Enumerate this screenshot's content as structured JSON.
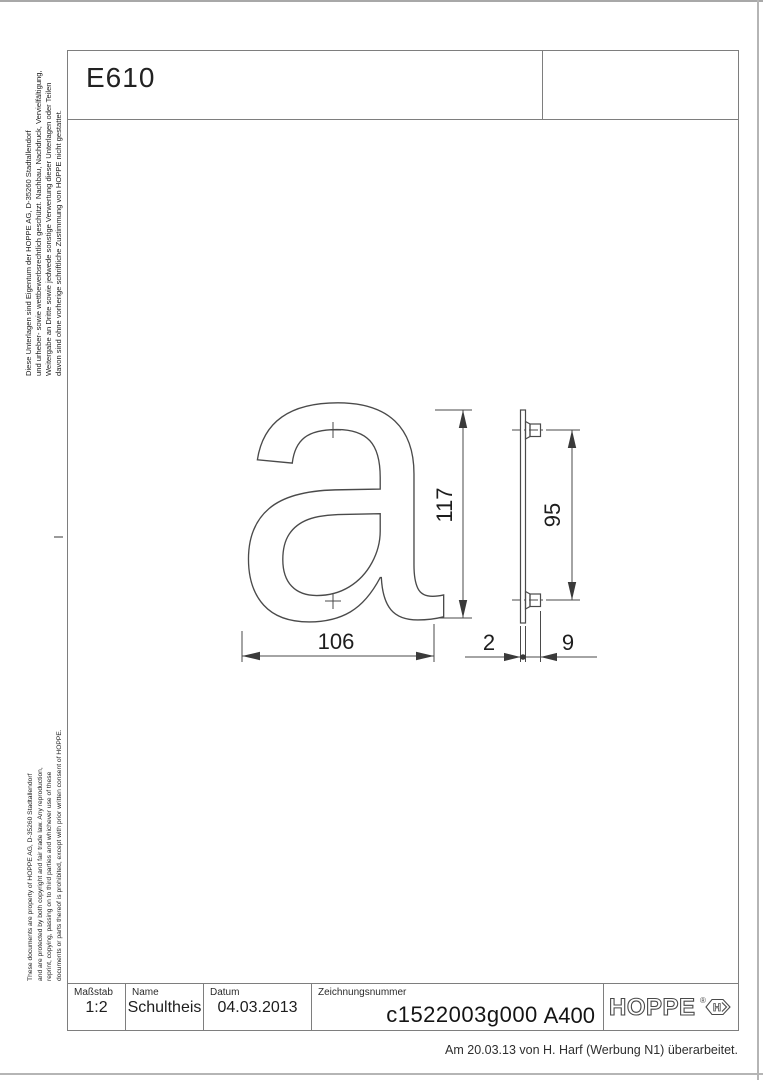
{
  "header": {
    "product_code": "E610"
  },
  "legal": {
    "german_lines": [
      "Diese Unterlagen sind Eigentum der  HOPPE AG, D-35260 Stadtallendorf",
      "und urheber- sowie wettbewerbsrechtlich geschützt. Nachbau, Nachdruck, Vervielfältigung,",
      "Weitergabe an Dritte sowie jedwede sonstige Verwertung dieser Unterlagen oder Teilen",
      "davon sind ohne vorherige schriftliche Zustimmung von HOPPE nicht gestattet."
    ],
    "english_lines": [
      "These documents are property of HOPPE AG, D-35260 Stadtallendorf",
      "and are protected by both copyright and fair trade law. Any reproduction,",
      "reprint, copying, passing on to third parties and whichever use of these",
      "documents or parts thereof is prohibited, except with prior written consent of HOPPE."
    ]
  },
  "drawing": {
    "letter": "a",
    "dimensions": {
      "width": "106",
      "height": "117",
      "stud_spacing": "95",
      "plate_thickness": "2",
      "depth": "9"
    }
  },
  "title_block": {
    "scale_label": "Maßstab",
    "scale_value": "1:2",
    "name_label": "Name",
    "name_value": "Schultheis",
    "date_label": "Datum",
    "date_value": "04.03.2013",
    "drawing_number_label": "Zeichnungsnummer",
    "drawing_number_value": "c1522003g000",
    "format_value": "A400",
    "logo_text": "HOPPE",
    "logo_registered": "®",
    "logo_mark_letter": "H"
  },
  "footer": {
    "revision_note": "Am 20.03.13 von H. Harf (Werbung N1) überarbeitet."
  }
}
